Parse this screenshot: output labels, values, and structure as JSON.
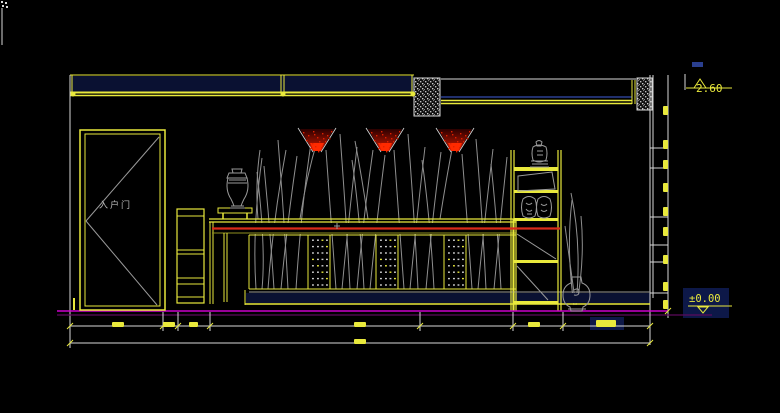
{
  "meta": {
    "type": "cad-interior-elevation",
    "background": "#000000"
  },
  "labels": {
    "level_top": "2.60",
    "level_bottom": "±0.00",
    "door": "入户门"
  },
  "colors": {
    "Y": "#e9e93c",
    "W": "#d8d8d8",
    "G": "#9a9a9a",
    "N": "#2a3f8f",
    "R": "#d92b1a",
    "M": "#cc00cc",
    "DM": "#5c0a5c",
    "DY": "#8f8f1f",
    "NV": "#0a1132",
    "HL": "#0d1848",
    "CONE_CORE": "#ff2a00",
    "CONE_TOP": "#2b0000",
    "CONE_MID": "#8f0f00"
  },
  "drawing": {
    "branches": [
      "M256,289 Q252,230 262,158",
      "M262,289 Q266,248 257,172",
      "M268,289 Q273,220 286,150",
      "M274,289 Q270,228 264,166",
      "M281,289 Q287,224 297,156",
      "M288,289 Q284,214 278,140",
      "M296,289 Q301,210 311,143",
      "M336,289 Q332,230 326,150",
      "M342,289 Q348,224 357,147",
      "M350,289 Q346,214 340,134",
      "M357,289 Q363,220 373,150",
      "M364,289 Q360,216 352,160",
      "M370,289 Q376,226 385,155",
      "M404,289 Q400,230 394,150",
      "M410,289 Q416,224 425,147",
      "M418,289 Q414,210 408,134",
      "M426,289 Q432,220 441,152",
      "M434,289 Q430,216 422,160",
      "M472,289 Q468,230 462,154",
      "M478,289 Q484,224 493,149",
      "M486,289 Q482,210 476,139",
      "M494,289 Q500,224 507,157",
      "M501,289 Q497,220 491,164",
      "M300,219 Q306,178 318,138",
      "M368,219 Q362,178 355,141",
      "M440,219 Q446,180 453,144",
      "M258,219 Q255,185 260,150",
      "M574,305 Q566,250 572,200",
      "M576,305 Q582,245 571,193",
      "M577,303 Q585,258 581,216",
      "M575,300 Q570,262 565,226"
    ],
    "blackouts": [
      [
        210,
        223,
        306,
        11
      ],
      [
        308,
        236,
        22,
        53
      ],
      [
        376,
        236,
        22,
        53
      ],
      [
        444,
        236,
        22,
        53
      ]
    ],
    "fills": [
      [
        71,
        76,
        343,
        16,
        "NV"
      ],
      [
        246,
        293,
        404,
        10,
        "NV"
      ],
      [
        683,
        288,
        46,
        30,
        "HL"
      ],
      [
        692,
        62,
        11,
        5,
        "N"
      ],
      [
        590,
        317,
        34,
        13,
        "HL"
      ]
    ],
    "hatch": [
      [
        414,
        78,
        26,
        38
      ],
      [
        637,
        78,
        15,
        32
      ]
    ],
    "lines": [
      [
        70,
        75,
        414,
        75,
        "Y",
        1
      ],
      [
        70,
        92.5,
        414,
        92.5,
        "Y",
        2
      ],
      [
        70,
        95.5,
        414,
        95.5,
        "Y",
        1.5
      ],
      [
        72,
        75,
        72,
        96,
        "Y",
        1
      ],
      [
        281,
        75,
        281,
        93,
        "Y",
        1
      ],
      [
        284,
        75,
        284,
        93,
        "Y",
        1
      ],
      [
        412,
        75,
        412,
        96,
        "Y",
        1
      ],
      [
        441,
        79,
        636,
        79,
        "W",
        1
      ],
      [
        441,
        97,
        632,
        97,
        "N",
        1.5
      ],
      [
        441,
        100.5,
        632,
        100.5,
        "Y",
        1.5
      ],
      [
        441,
        103.5,
        632,
        103.5,
        "Y",
        1.5
      ],
      [
        632,
        80,
        632,
        104,
        "Y",
        1
      ],
      [
        635,
        80,
        635,
        104,
        "Y",
        1
      ],
      [
        70,
        75,
        70,
        348,
        "W",
        1
      ],
      [
        650,
        75,
        650,
        345,
        "W",
        1
      ],
      [
        653,
        75,
        653,
        298,
        "W",
        1
      ],
      [
        668,
        75,
        668,
        318,
        "W",
        1
      ],
      [
        685,
        74,
        685,
        90,
        "W",
        1
      ],
      [
        650,
        148,
        668,
        148,
        "W",
        1
      ],
      [
        650,
        168,
        668,
        168,
        "W",
        1
      ],
      [
        650,
        217,
        668,
        217,
        "W",
        1
      ],
      [
        650,
        245,
        668,
        245,
        "W",
        1
      ],
      [
        650,
        262,
        668,
        262,
        "W",
        1
      ],
      [
        650,
        293,
        668,
        293,
        "W",
        1
      ],
      [
        686,
        88,
        732,
        88,
        "Y",
        1
      ],
      [
        688,
        306,
        732,
        306,
        "Y",
        1
      ],
      [
        159,
        137,
        86,
        221,
        "G",
        1
      ],
      [
        86,
        221,
        157,
        305,
        "G",
        1
      ],
      [
        74,
        298,
        74,
        310,
        "Y",
        2
      ],
      [
        177,
        216,
        204,
        216,
        "Y",
        1
      ],
      [
        177,
        250,
        204,
        250,
        "Y",
        1
      ],
      [
        177,
        254,
        204,
        254,
        "Y",
        1
      ],
      [
        177,
        278,
        204,
        278,
        "Y",
        1
      ],
      [
        177,
        284,
        204,
        284,
        "Y",
        1
      ],
      [
        177,
        297,
        204,
        297,
        "Y",
        1
      ],
      [
        223,
        213,
        223,
        219,
        "Y",
        1.5
      ],
      [
        247,
        213,
        247,
        219,
        "Y",
        1.5
      ],
      [
        209,
        219,
        516,
        219,
        "Y",
        1.2
      ],
      [
        209,
        222,
        516,
        222,
        "Y",
        1.2
      ],
      [
        210,
        222,
        210,
        304,
        "Y",
        1
      ],
      [
        213,
        222,
        213,
        304,
        "Y",
        1
      ],
      [
        212,
        233,
        516,
        233,
        "DY",
        1
      ],
      [
        224,
        233,
        224,
        302,
        "Y",
        1
      ],
      [
        227,
        233,
        227,
        302,
        "Y",
        1
      ],
      [
        249,
        235,
        516,
        235,
        "Y",
        1
      ],
      [
        249,
        289,
        516,
        289,
        "Y",
        1
      ],
      [
        249,
        235,
        249,
        289,
        "Y",
        1
      ],
      [
        308,
        235,
        308,
        289,
        "Y",
        1
      ],
      [
        330,
        235,
        330,
        289,
        "Y",
        1
      ],
      [
        376,
        235,
        376,
        289,
        "Y",
        1
      ],
      [
        398,
        235,
        398,
        289,
        "Y",
        1
      ],
      [
        444,
        235,
        444,
        289,
        "Y",
        1
      ],
      [
        466,
        235,
        466,
        289,
        "Y",
        1
      ],
      [
        513,
        219,
        513,
        311,
        "Y",
        1.2
      ],
      [
        516,
        219,
        516,
        311,
        "Y",
        1.2
      ],
      [
        249,
        292,
        650,
        292,
        "G",
        1
      ],
      [
        245,
        290,
        245,
        305,
        "Y",
        1
      ],
      [
        245,
        304,
        650,
        304,
        "Y",
        1.5
      ],
      [
        511,
        150,
        511,
        311,
        "Y",
        1.2
      ],
      [
        514,
        150,
        514,
        311,
        "Y",
        1.2
      ],
      [
        558,
        150,
        558,
        311,
        "Y",
        1.2
      ],
      [
        561,
        150,
        561,
        311,
        "Y",
        1.2
      ],
      [
        517,
        234,
        556,
        259,
        "G",
        1
      ],
      [
        517,
        266,
        548,
        300,
        "G",
        1
      ],
      [
        212,
        228.5,
        560,
        228.5,
        "R",
        2.2
      ],
      [
        334,
        226,
        340,
        226,
        "G",
        1
      ],
      [
        337,
        223,
        337,
        229,
        "G",
        1
      ],
      [
        57,
        311,
        668,
        311,
        "M",
        1.6
      ],
      [
        57,
        315,
        712,
        315,
        "DM",
        1.2
      ],
      [
        70,
        326,
        650,
        326,
        "W",
        1
      ],
      [
        70,
        343,
        650,
        343,
        "W",
        1
      ],
      [
        163,
        312,
        163,
        331,
        "W",
        1
      ],
      [
        178,
        312,
        178,
        331,
        "W",
        1
      ],
      [
        210,
        312,
        210,
        331,
        "W",
        1
      ],
      [
        420,
        312,
        420,
        331,
        "W",
        1
      ],
      [
        513,
        312,
        513,
        331,
        "W",
        1
      ],
      [
        563,
        312,
        563,
        331,
        "W",
        1
      ],
      [
        650,
        312,
        650,
        345,
        "W",
        1
      ],
      [
        2,
        8,
        2,
        45,
        "W",
        1
      ]
    ],
    "rects": [
      [
        80,
        130,
        85,
        180,
        "Y",
        1.5
      ],
      [
        85,
        134,
        75,
        172,
        "Y",
        1
      ],
      [
        177,
        209,
        27,
        94,
        "Y",
        1.2
      ],
      [
        218,
        208,
        34,
        5,
        "Y",
        1
      ]
    ],
    "fill_rects": [
      [
        514,
        167,
        44,
        4,
        "Y"
      ],
      [
        514,
        190,
        44,
        3,
        "Y"
      ],
      [
        514,
        218,
        44,
        3,
        "Y"
      ],
      [
        514,
        260,
        44,
        3,
        "Y"
      ],
      [
        514,
        301,
        44,
        3,
        "Y"
      ],
      [
        1,
        1,
        2,
        2,
        "W"
      ],
      [
        5,
        2,
        2,
        2,
        "W"
      ],
      [
        2,
        5,
        2,
        2,
        "W"
      ],
      [
        6,
        6,
        2,
        2,
        "W"
      ]
    ],
    "circles": [
      [
        73,
        94,
        2.5,
        "Y"
      ],
      [
        283,
        94,
        2.5,
        "Y"
      ],
      [
        413,
        94,
        2.5,
        "Y"
      ]
    ],
    "polys": [
      {
        "p": "518,176 552,172 555,189 518,191",
        "s": "G",
        "w": 1
      },
      {
        "p": "700,79 694,88 706,88",
        "s": "Y",
        "w": 1
      },
      {
        "p": "698,307 708,307 703,313",
        "s": "Y",
        "w": 1
      }
    ],
    "paths": [
      {
        "d": "M232,169 h10 l-1,4 h-8 z",
        "s": "G",
        "w": 1
      },
      {
        "d": "M229,173 h16 l2,5 h-20 z M229,180 h17 M228,183 h19",
        "s": "G",
        "w": 1
      },
      {
        "d": "M228,178 q-3,12 3,21 q2,4 3,7 h7 q1,-3 3,-7 q6,-9 3,-21 z M231,206 h13 M230,208 h15",
        "s": "G",
        "w": 1
      },
      {
        "d": "M536,142 q3,-3 6,0 l-1,4 h-4 z M533,147 q6,-4 13,0 q2,6 0,13 q-7,4 -13,0 q-2,-7 0,-13 z M537,151 h6 M537,155 h6 M531,161 h17 M532,164 h16 M530,167 h19",
        "s": "G",
        "w": 1
      },
      {
        "d": "M523,199 q6,-5 12,0 q3,8 0,17 q-6,4 -12,0 q-3,-9 0,-17 z M526,203 q3,3 6,0 M526,209 q3,4 6,1 M527,214 h5",
        "s": "G",
        "w": 1
      },
      {
        "d": "M538,199 q6,-5 12,0 q3,8 0,17 q-6,4 -12,0 q-3,-9 0,-17 z M541,204 q3,3 6,0 M541,210 q3,3 6,0",
        "s": "G",
        "w": 1
      },
      {
        "d": "M572,277 h9 l1,6 q8,3 8,12 q0,9 -7,12 l-1,4 h-11 l-1,-4 q-7,-3 -7,-12 q0,-9 8,-12 z M568,309 h18 M574,290 q5,-3 5,2 q0,4 -5,3",
        "s": "G",
        "w": 1
      }
    ],
    "mesh": {
      "panels": [
        308,
        376,
        444
      ],
      "cols": [
        4,
        9,
        13.5,
        18
      ],
      "top": 239.5,
      "step": 6.4,
      "rows": 8,
      "w": 1.9,
      "h": 1.4
    },
    "cones": {
      "centers": [
        317,
        385,
        455
      ],
      "top": 129,
      "tip": 151,
      "half_top": 17,
      "speckles": [
        [
          -14,
          3
        ],
        [
          -9,
          6
        ],
        [
          -4,
          2
        ],
        [
          0,
          8
        ],
        [
          5,
          4
        ],
        [
          10,
          6
        ],
        [
          14,
          2
        ],
        [
          -11,
          11
        ],
        [
          -5,
          14
        ],
        [
          2,
          12
        ],
        [
          8,
          12
        ],
        [
          12,
          9
        ],
        [
          -2,
          17
        ],
        [
          4,
          18
        ],
        [
          -7,
          19
        ],
        [
          1,
          22
        ],
        [
          -3,
          5
        ],
        [
          6,
          9
        ]
      ]
    },
    "dim_blobs": [
      [
        112,
        322,
        12,
        5
      ],
      [
        163,
        322,
        12,
        5
      ],
      [
        189,
        322,
        9,
        5
      ],
      [
        354,
        322,
        12,
        5
      ],
      [
        528,
        322,
        12,
        5
      ],
      [
        596,
        320,
        20,
        7
      ],
      [
        354,
        339,
        12,
        5
      ],
      [
        663,
        106,
        5,
        9
      ],
      [
        663,
        140,
        5,
        9
      ],
      [
        663,
        160,
        5,
        9
      ],
      [
        663,
        183,
        5,
        9
      ],
      [
        663,
        207,
        5,
        9
      ],
      [
        663,
        227,
        5,
        9
      ],
      [
        663,
        255,
        5,
        9
      ],
      [
        663,
        282,
        5,
        9
      ],
      [
        663,
        300,
        5,
        9
      ]
    ],
    "dim_ticks": [
      [
        70,
        326
      ],
      [
        163,
        326
      ],
      [
        178,
        326
      ],
      [
        210,
        326
      ],
      [
        420,
        326
      ],
      [
        513,
        326
      ],
      [
        563,
        326
      ],
      [
        650,
        326
      ],
      [
        70,
        343
      ],
      [
        650,
        343
      ],
      [
        668,
        311
      ]
    ]
  }
}
